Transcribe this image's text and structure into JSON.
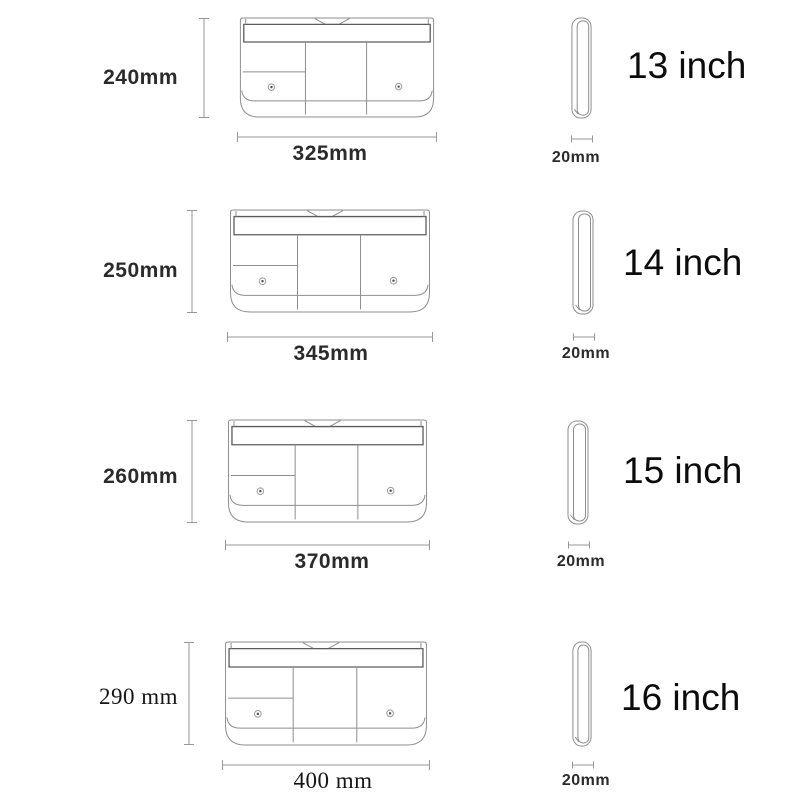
{
  "rows": [
    {
      "size": "13 inch",
      "height": "240mm",
      "width": "325mm",
      "thickness": "20mm"
    },
    {
      "size": "14 inch",
      "height": "250mm",
      "width": "345mm",
      "thickness": "20mm"
    },
    {
      "size": "15 inch",
      "height": "260mm",
      "width": "370mm",
      "thickness": "20mm"
    },
    {
      "size": "16 inch",
      "height": "290 mm",
      "width": "400 mm",
      "thickness": "20mm"
    }
  ],
  "colors": {
    "background": "#ffffff",
    "drawing_line": "#8e8e8e",
    "drawing_line_dark": "#5c5c5c",
    "dimension_line": "#979797",
    "text": "#2b2b2b",
    "size_text": "#0c0c0c"
  }
}
